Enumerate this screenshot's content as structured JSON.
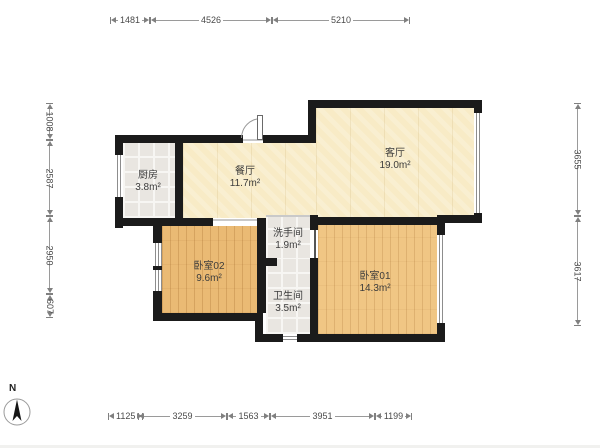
{
  "rooms": {
    "kitchen": {
      "name": "厨房",
      "area": "3.8m²"
    },
    "dining": {
      "name": "餐厅",
      "area": "11.7m²"
    },
    "living": {
      "name": "客厅",
      "area": "19.0m²"
    },
    "washroom": {
      "name": "洗手间",
      "area": "1.9m²"
    },
    "bedroom02": {
      "name": "卧室02",
      "area": "9.6m²"
    },
    "bathroom": {
      "name": "卫生间",
      "area": "3.5m²"
    },
    "bedroom01": {
      "name": "卧室01",
      "area": "14.3m²"
    }
  },
  "dimensions": {
    "top": [
      "1481",
      "4526",
      "5210"
    ],
    "bottom": [
      "1125",
      "3259",
      "1563",
      "3951",
      "1199"
    ],
    "left": [
      "1008",
      "2587",
      "2950",
      "607"
    ],
    "right": [
      "3655",
      "3617"
    ]
  },
  "compass": {
    "label": "N"
  },
  "colors": {
    "wall": "#1b1b1b",
    "floor_cream": "#f8ebc6",
    "floor_wood_dark": "#eaba74",
    "floor_wood_light": "#f0c684",
    "floor_tile": "#e9e6e1",
    "window_line": "#8d8d8d",
    "dimension_text": "#4a4a4a"
  }
}
